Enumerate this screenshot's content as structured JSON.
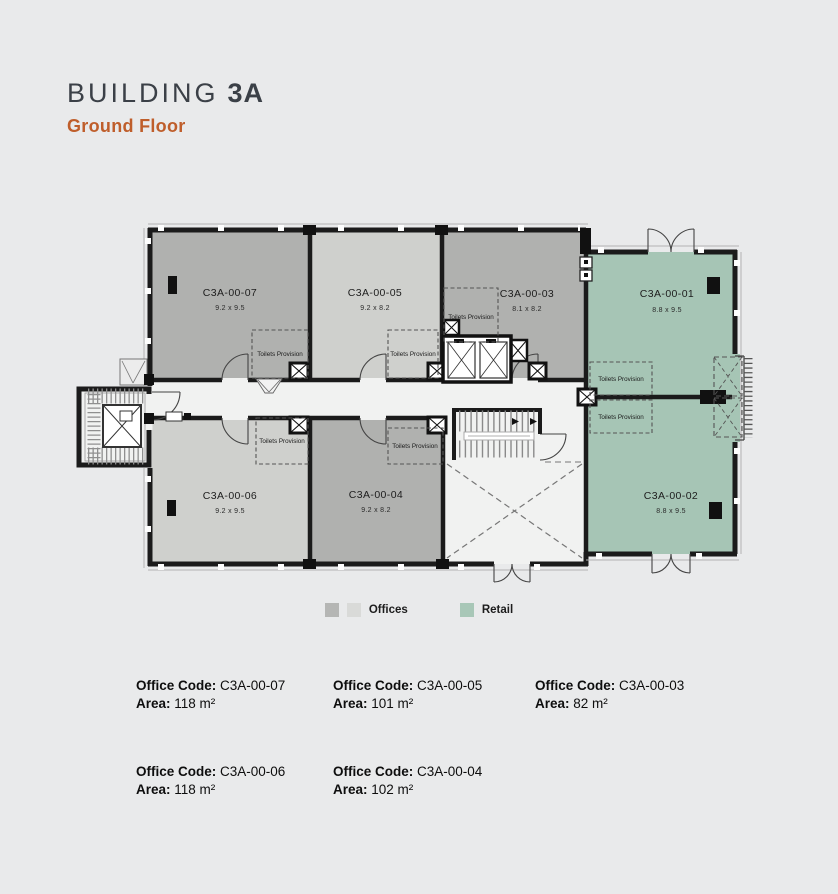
{
  "page": {
    "background": "#e9eaeb"
  },
  "header": {
    "title_prefix": "BUILDING",
    "title_bold": "3A",
    "subtitle": "Ground Floor"
  },
  "plan": {
    "toilets_label": "Toilets Provision",
    "colors": {
      "office_dark": "#b0b1af",
      "office_light": "#cfd0cd",
      "retail": "#a6c5b5",
      "floor": "#f1f2f1",
      "wall": "#1b1b1b"
    },
    "units": [
      {
        "code": "C3A-00-07",
        "dims": "9.2 x 9.5",
        "category": "office"
      },
      {
        "code": "C3A-00-05",
        "dims": "9.2 x 8.2",
        "category": "office"
      },
      {
        "code": "C3A-00-03",
        "dims": "8.1 x 8.2",
        "category": "office"
      },
      {
        "code": "C3A-00-01",
        "dims": "8.8 x 9.5",
        "category": "retail"
      },
      {
        "code": "C3A-00-06",
        "dims": "9.2 x 9.5",
        "category": "office"
      },
      {
        "code": "C3A-00-04",
        "dims": "9.2 x 8.2",
        "category": "office"
      },
      {
        "code": "C3A-00-02",
        "dims": "8.8 x 9.5",
        "category": "retail"
      }
    ]
  },
  "legend": {
    "offices_label": "Offices",
    "retail_label": "Retail",
    "colors": {
      "office_dark": "#b5b6b4",
      "office_light": "#d9dad8",
      "retail": "#a8c7b7"
    }
  },
  "details": {
    "office_code_label": "Office Code:",
    "area_label": "Area:",
    "rows": [
      [
        {
          "code": "C3A-00-07",
          "area": "118 m²"
        },
        {
          "code": "C3A-00-05",
          "area": "101 m²"
        },
        {
          "code": "C3A-00-03",
          "area": "82 m²"
        }
      ],
      [
        {
          "code": "C3A-00-06",
          "area": "118 m²"
        },
        {
          "code": "C3A-00-04",
          "area": "102 m²"
        }
      ]
    ]
  }
}
